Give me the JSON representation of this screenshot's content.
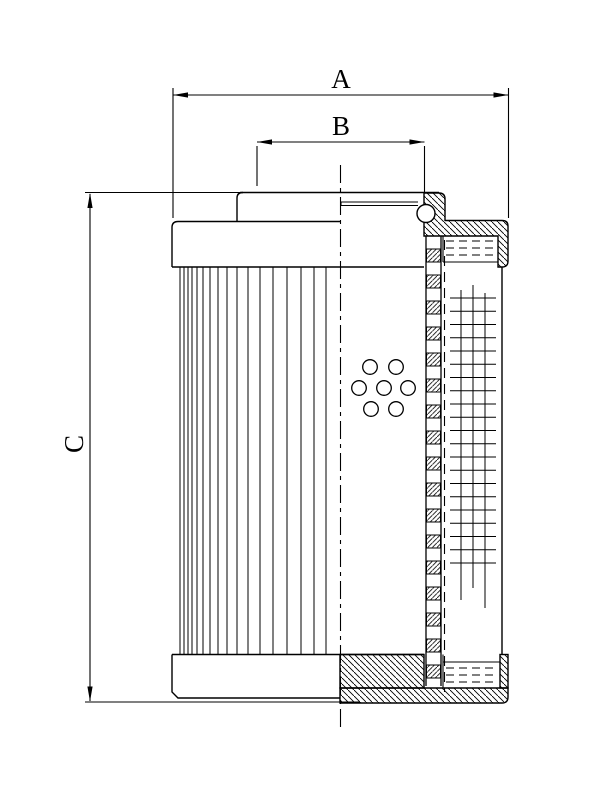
{
  "drawing": {
    "labels": {
      "dim_a": "A",
      "dim_b": "B",
      "dim_c": "C"
    },
    "colors": {
      "line": "#000000",
      "background": "#ffffff"
    },
    "counts": {
      "perforation_holes": 7,
      "pleats": 17,
      "core_tube_segments": 17
    }
  }
}
